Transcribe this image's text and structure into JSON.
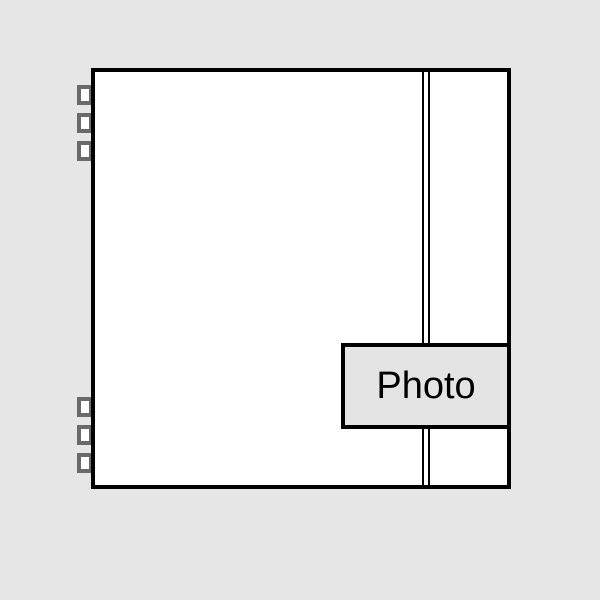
{
  "figure": {
    "type": "photo-album-placeholder",
    "label": {
      "text": "Photo"
    },
    "rings": {
      "top": 3,
      "bottom": 3
    },
    "spine": {
      "lines": 2
    },
    "colors": {
      "background": "#e6e6e6",
      "page_fill": "#ffffff",
      "outline": "#000000",
      "ring_gray": "#6a6a6a",
      "label_fill": "#e4e4e4",
      "label_text": "#000000"
    }
  }
}
